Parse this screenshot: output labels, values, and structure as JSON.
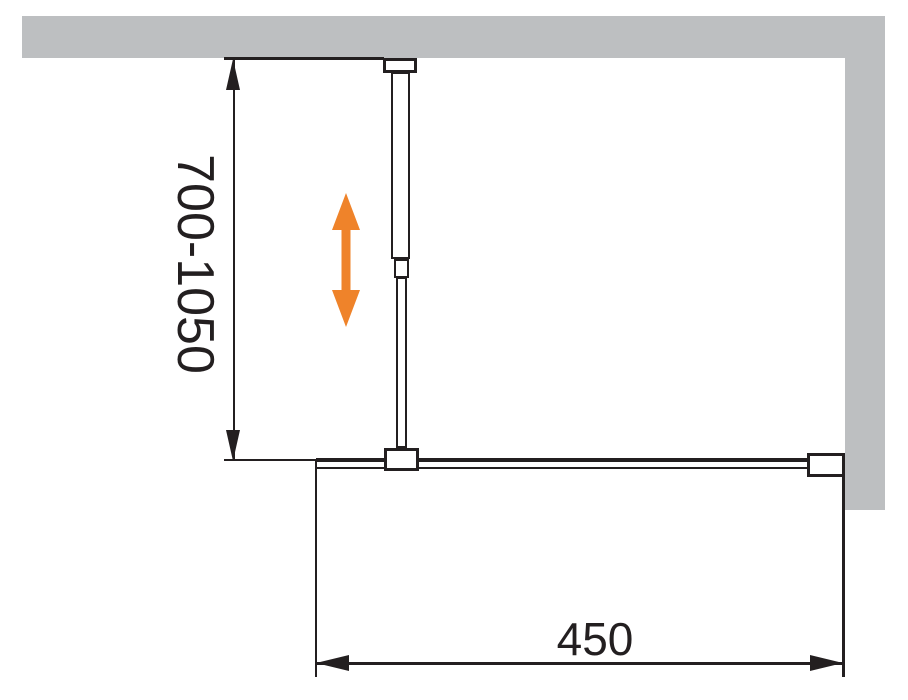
{
  "diagram": {
    "dimensions": {
      "height_range": "700-1050",
      "width": "450"
    },
    "colors": {
      "wall": "#bdbfc1",
      "line": "#231f20",
      "accent": "#ef832a",
      "bg": "#ffffff"
    },
    "icons": {
      "adjustability": "vertical-double-arrow",
      "dimension_markers": "filled-arrowheads"
    }
  }
}
